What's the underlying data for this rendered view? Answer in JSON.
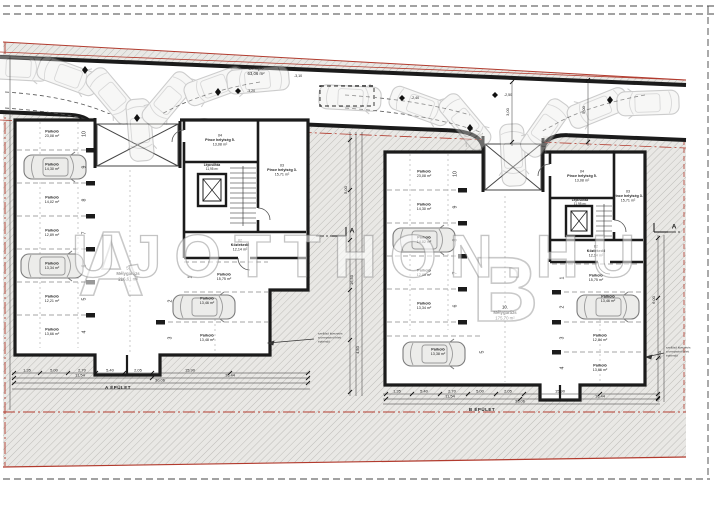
{
  "watermark": {
    "text": "UJOTTHON.HU",
    "letter_a": "A",
    "letter_b": "B"
  },
  "ramp": {
    "name": "Lehajtó",
    "area": "63,06 m²"
  },
  "levels": {
    "l1": "-3,20",
    "l2": "-3,10",
    "l3": "-2,40",
    "l4": "-2,50"
  },
  "section": {
    "letter": "A"
  },
  "annotation": {
    "line1": "szellőző kivezetés",
    "line2": "a terepszint felett",
    "line3": "építendő"
  },
  "building_a": {
    "dim_label": "A ÉPÜLET",
    "garage": {
      "no": "5.",
      "name": "Mélygarázs",
      "area": "216,61 m²"
    },
    "rooms": {
      "r04": {
        "no": "04",
        "name": "Pince helyiség 5.",
        "area": "13,08 m²"
      },
      "r03": {
        "no": "03",
        "name": "Pince helyiség 3.",
        "area": "15,71 m²"
      },
      "r01": {
        "no": "01",
        "name": "Lépcsőház",
        "area": "11,95 m²"
      },
      "r02": {
        "no": "02",
        "name": "Közlekedő",
        "area": "12,14 m²"
      }
    },
    "bays": [
      {
        "no": "10",
        "label": "Parkoló",
        "area": "23,08 m²"
      },
      {
        "no": "9",
        "label": "Parkoló",
        "area": "14,30 m²"
      },
      {
        "no": "8",
        "label": "Parkoló",
        "area": "14,02 m²"
      },
      {
        "no": "7",
        "label": "Parkoló",
        "area": "12,89 m²"
      },
      {
        "no": "6",
        "label": "Parkoló",
        "area": "13,34 m²"
      },
      {
        "no": "5",
        "label": "Parkoló",
        "area": "12,21 m²"
      },
      {
        "no": "4",
        "label": "Parkoló",
        "area": "13,66 m²"
      },
      {
        "no": "3",
        "label": "Parkoló",
        "area": "13,48 m²"
      },
      {
        "no": "2",
        "label": "Parkoló",
        "area": "13,46 m²"
      },
      {
        "no": "1",
        "label": "Parkoló",
        "area": "15,75 m²"
      }
    ]
  },
  "building_b": {
    "dim_label": "B ÉPÜLET",
    "garage": {
      "no": "10.",
      "name": "Mélygarázs",
      "area": "175,70 m²"
    },
    "rooms": {
      "r04": {
        "no": "04",
        "name": "Pince helyiség 5.",
        "area": "13,08 m²"
      },
      "r03": {
        "no": "03",
        "name": "Pince helyiség 3.",
        "area": "15,71 m²"
      },
      "r01": {
        "no": "01",
        "name": "Lépcsőház",
        "area": "11,95 m²"
      },
      "r02": {
        "no": "02",
        "name": "Közlekedő",
        "area": "12,14 m²"
      }
    },
    "bays": [
      {
        "no": "10",
        "label": "Parkoló",
        "area": "23,08 m²"
      },
      {
        "no": "9",
        "label": "Parkoló",
        "area": "14,30 m²"
      },
      {
        "no": "8",
        "label": "Parkoló",
        "area": "14,02 m²"
      },
      {
        "no": "7",
        "label": "Parkoló",
        "area": "12,89 m²"
      },
      {
        "no": "6",
        "label": "Parkoló",
        "area": "13,34 m²"
      },
      {
        "no": "5",
        "label": "Parkoló",
        "area": "13,38 m²"
      },
      {
        "no": "1",
        "label": "Parkoló",
        "area": "15,75 m²"
      },
      {
        "no": "2",
        "label": "Parkoló",
        "area": "13,46 m²"
      },
      {
        "no": "3",
        "label": "Parkoló",
        "area": "12,84 m²"
      },
      {
        "no": "4",
        "label": "Parkoló",
        "area": "13,66 m²"
      }
    ]
  },
  "dims": {
    "a1": [
      "1,35",
      "5,00",
      "2,70",
      "5,40",
      "2,05",
      "15,90"
    ],
    "a2": [
      "11,54",
      "16,44"
    ],
    "a3": [
      "30,06"
    ],
    "b1": [
      "1,35",
      "5,40",
      "2,70",
      "5,00",
      "2,05",
      "15,90"
    ],
    "b2": [
      "11,54",
      "16,44"
    ],
    "b3": [
      "30,06"
    ],
    "v": [
      "5,00",
      "16,50",
      "4,50",
      "6,00",
      "5,50",
      "3,00",
      "5,00"
    ]
  },
  "colors": {
    "boundary_red": "#b23b2e",
    "wall": "#1b1b1b",
    "hatch_line": "#bdbcb8"
  }
}
